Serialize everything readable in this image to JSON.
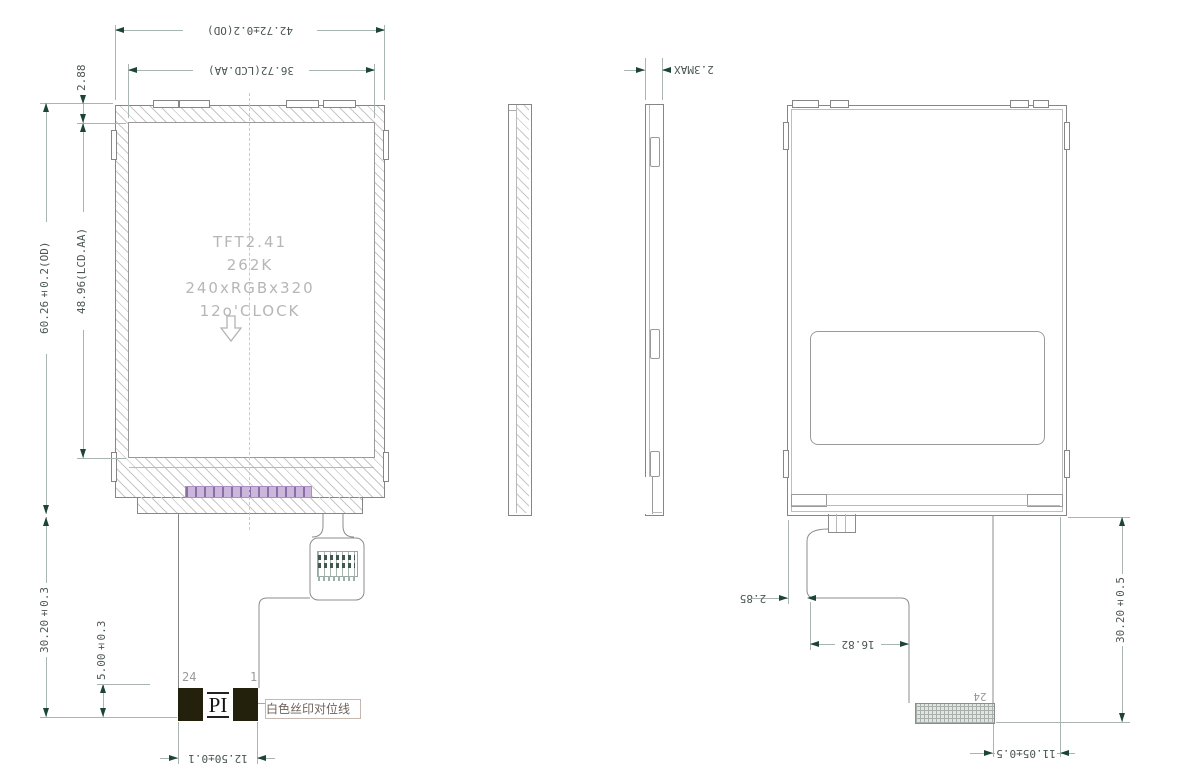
{
  "drawing_type": "LCD module mechanical drawing",
  "dims": {
    "od_width": "42.72±0.2(OD)",
    "aa_width": "36.72(LCD.AA)",
    "border_top": "2.88",
    "od_height": "60.26±0.2(OD)",
    "aa_height": "48.96(LCD.AA)",
    "fpc_length_front": "30.20±0.3",
    "stiffener_height": "5.00±0.3",
    "stiffener_width": "12.50±0.1",
    "thickness": "2.3MAX",
    "fpc_edge_offset": "2.85",
    "fpc_step_width": "16.82",
    "fpc_length_back": "30.20±0.5",
    "connector_offset": "11.05±0.5"
  },
  "screen_text": {
    "line1": "TFT2.41",
    "line2": "262K",
    "line3": "240xRGBx320",
    "line4": "12o'CLOCK"
  },
  "labels": {
    "pin_first": "24",
    "pin_last": "1",
    "pin_back": "24",
    "stiffener": "PI",
    "silkscreen_note": "白色丝印对位线"
  },
  "colors": {
    "dim_arrow": "#1d4536",
    "dim_line": "#a9b6af",
    "dim_text": "#4a574f",
    "outline": "#868686",
    "hatch": "#c7c7c7",
    "screen_text": "#b6b6b6",
    "fpc_pad_bg": "#cbb6dc",
    "fpc_pad_tick": "#8d6ca8",
    "stiffener_bg": "#23200b"
  }
}
